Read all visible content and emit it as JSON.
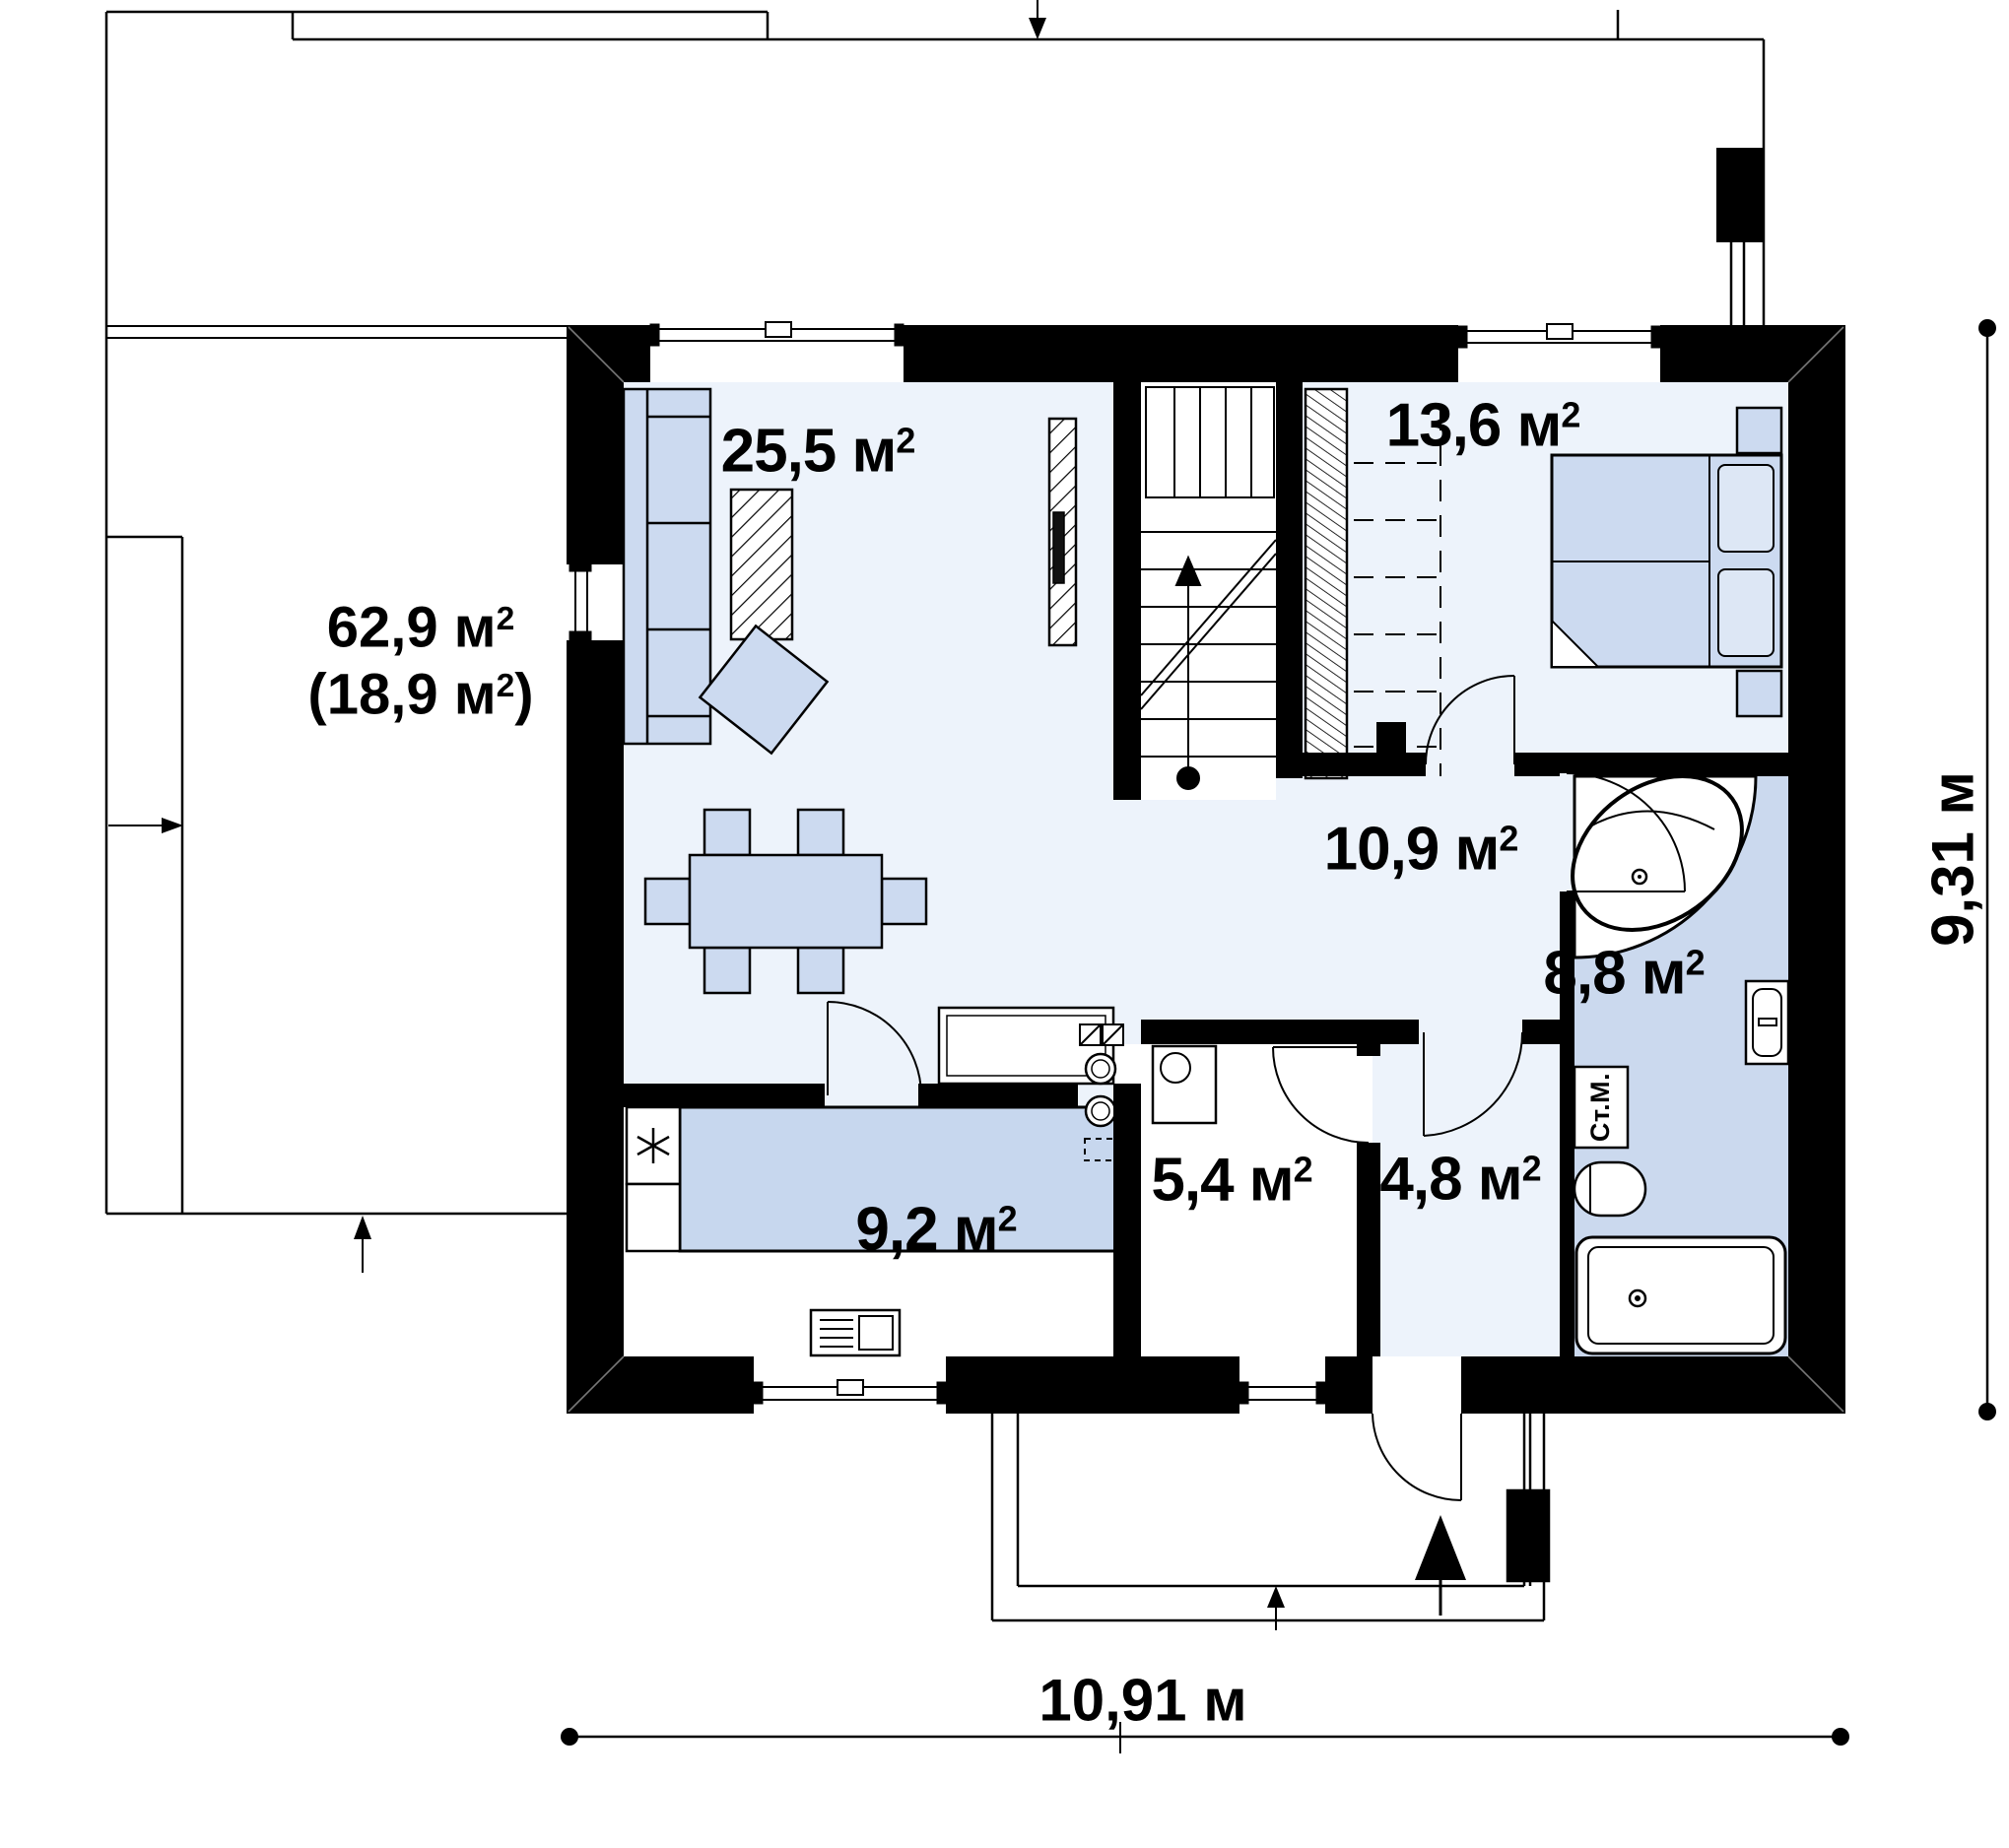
{
  "rooms": {
    "living": {
      "area": "25,5 м",
      "sup": "2"
    },
    "bedroom": {
      "area": "13,6 м",
      "sup": "2"
    },
    "hallway": {
      "area": "10,9 м",
      "sup": "2"
    },
    "bathroom": {
      "area": "8,8 м",
      "sup": "2"
    },
    "utility": {
      "area": "5,4  м",
      "sup": "2"
    },
    "hall_entry": {
      "area": "4,8 м",
      "sup": "2"
    },
    "kitchen": {
      "area": "9,2 м",
      "sup": "2"
    }
  },
  "terrace": {
    "line1": "62,9 м",
    "line1_sup": "2",
    "line2_open": "(18,9 м",
    "line2_sup": "2",
    "line2_close": ")"
  },
  "dimensions": {
    "width": "10,91 м",
    "height": "9,31 м"
  },
  "appliances": {
    "washing_machine": "Ст.М."
  },
  "colors": {
    "wall": "#000000",
    "floor_light": "#edf3fb",
    "floor_white": "#ffffff",
    "floor_bath": "#cbd9ee",
    "furniture_blue": "#ccdaf0",
    "counter_blue": "#c7d7ee",
    "line": "#000000"
  }
}
